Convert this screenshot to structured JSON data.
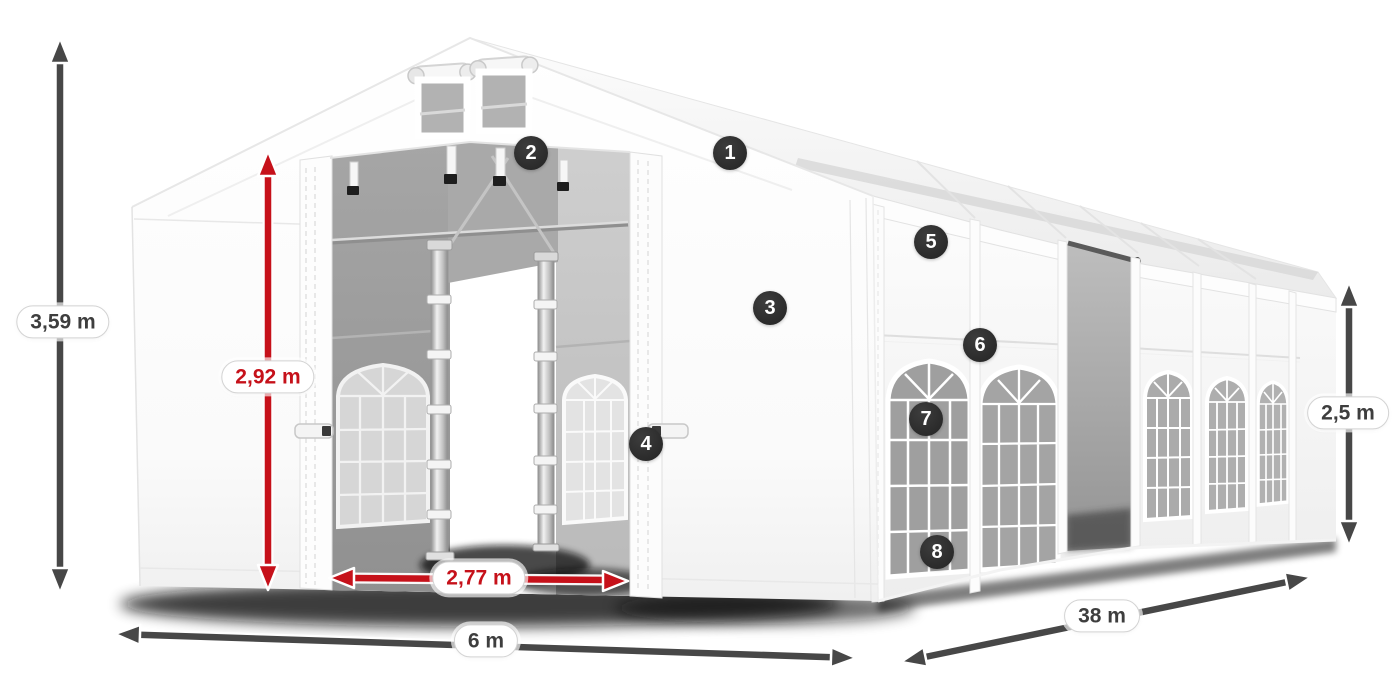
{
  "diagram": {
    "title": "Tent dimension diagram",
    "background": "#ffffff"
  },
  "colors": {
    "dimension_dark": "#474747",
    "dimension_red": "#c6111a",
    "badge_background": "#2d2d2d",
    "badge_text": "#ffffff",
    "tent_white": "#ffffff",
    "interior_gray": "#a5a5a5"
  },
  "dimensions": {
    "total_height": {
      "label": "3,59 m",
      "style": "dark"
    },
    "entrance_height": {
      "label": "2,92 m",
      "style": "red"
    },
    "entrance_width": {
      "label": "2,77 m",
      "style": "red"
    },
    "tent_width": {
      "label": "6 m",
      "style": "dark"
    },
    "tent_length": {
      "label": "38 m",
      "style": "dark"
    },
    "side_height": {
      "label": "2,5 m",
      "style": "dark"
    }
  },
  "callouts": [
    {
      "number": "1",
      "x": 730,
      "y": 153
    },
    {
      "number": "2",
      "x": 531,
      "y": 153
    },
    {
      "number": "3",
      "x": 770,
      "y": 308
    },
    {
      "number": "4",
      "x": 646,
      "y": 444
    },
    {
      "number": "5",
      "x": 931,
      "y": 242
    },
    {
      "number": "6",
      "x": 980,
      "y": 345
    },
    {
      "number": "7",
      "x": 926,
      "y": 419
    },
    {
      "number": "8",
      "x": 937,
      "y": 552
    }
  ]
}
